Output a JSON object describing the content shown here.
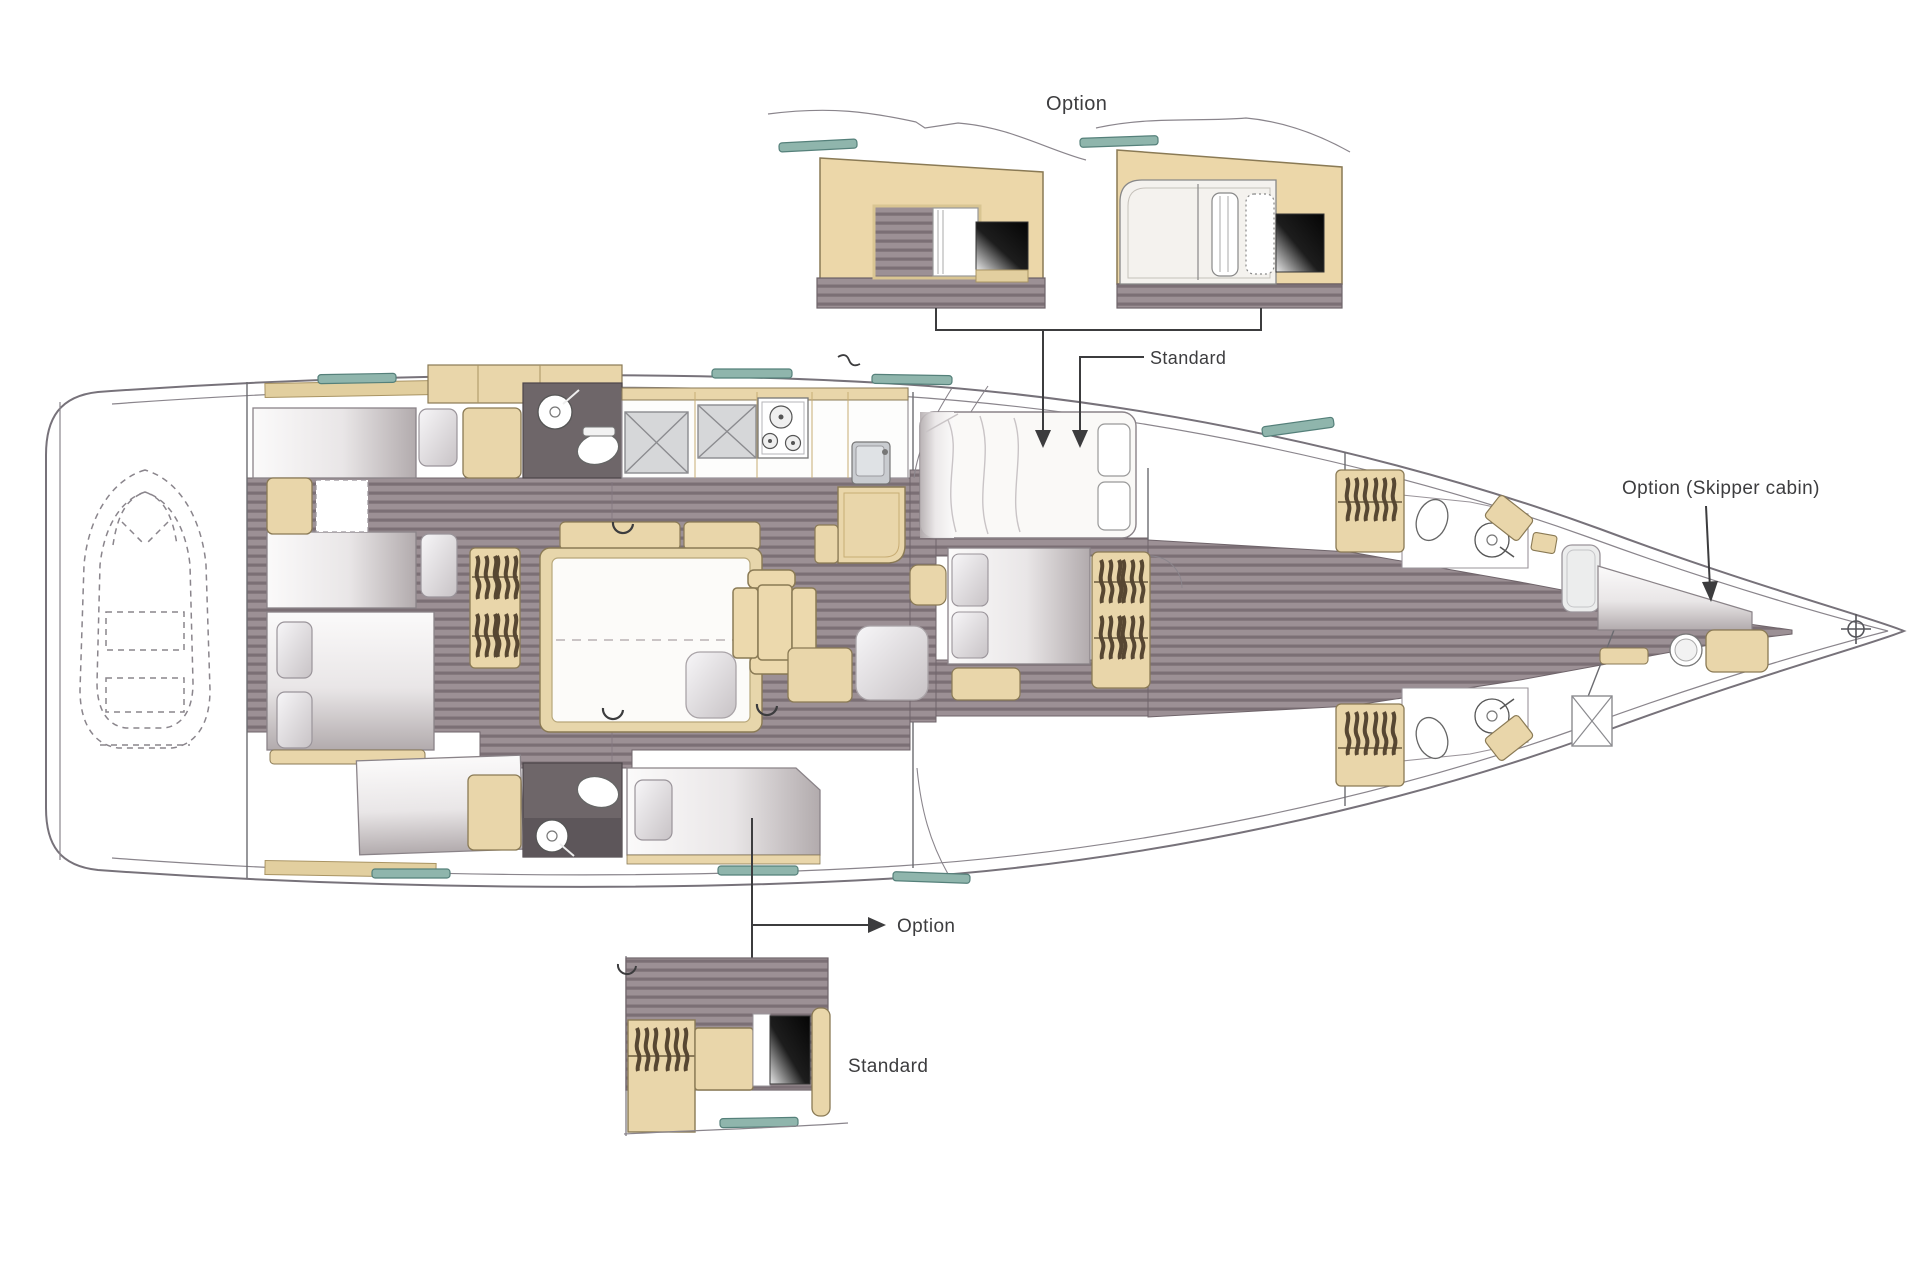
{
  "callouts": {
    "top_option": "Option",
    "top_standard": "Standard",
    "skipper": "Option (Skipper cabin)",
    "bottom_option": "Option",
    "bottom_standard": "Standard"
  },
  "colors": {
    "background": "#ffffff",
    "hull_outline": "#77727a",
    "wood_floor_base": "#9c9095",
    "wood_floor_stripe": "#7b6f75",
    "furniture_tan": "#e9d6aa",
    "furniture_tan_stroke": "#8a7a55",
    "head_floor_dark": "#6e6669",
    "deck_hatch_teal": "#8fb5ac",
    "glossy_black": "#0a0a0a",
    "mattress_shadow": "#b9b2b4",
    "label_text": "#3d3d3f"
  },
  "areas": {
    "tender_garage": "dinghy in stern garage (dashed)",
    "aft_cabins": "twin aft cabins with berths",
    "aft_heads": "two aft heads with shower and toilet",
    "galley": "galley with stove, sink and lockers",
    "salon": "salon berth, folding table and seats",
    "forward_bed": "forward double bed (option/standard configurations)",
    "forward_heads": "two forward heads with wardrobes",
    "skipper_cabin": "bow skipper cabin option"
  }
}
